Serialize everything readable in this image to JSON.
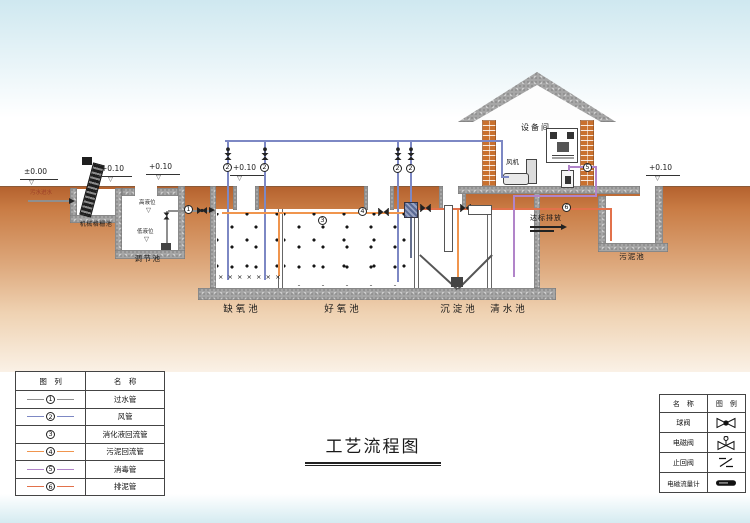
{
  "title": "工艺流程图",
  "colors": {
    "pipe_water": "#8f8f8f",
    "pipe_air": "#7d88c4",
    "pipe_sludge_return": "#f0954e",
    "pipe_disinfect": "#b184c9",
    "pipe_sludge_drain": "#e2714b",
    "brick": "#c9712f",
    "concrete": "#a6a6a6",
    "ground_top": "#b5622e",
    "ground_bottom": "#faf1e6",
    "sky": "#cfe8f0"
  },
  "levels": {
    "zero": "±0.00",
    "plus_10": "+0.10"
  },
  "labels": {
    "equipment_room": "设备间",
    "fan": "风机",
    "screen_tank": "机械格栅池",
    "regulating_tank": "调节池",
    "anoxic_tank": "缺氧池",
    "aerobic_tank": "好氧池",
    "sedimentation_tank": "沉淀池",
    "clear_water_tank": "清水池",
    "sludge_tank": "污泥池",
    "inlet": "污水进水",
    "high_level": "高液位",
    "low_level": "低液位",
    "discharge": "达标排放"
  },
  "markers": {
    "water": "1",
    "air": "2",
    "digest": "3",
    "sludge_return": "4",
    "disinfect": "5",
    "sludge_drain": "6"
  },
  "diffusers": "× × × × × × ×",
  "pipe_legend": {
    "col_symbol": "图　列",
    "col_name": "名　称",
    "rows": [
      {
        "num": "1",
        "name": "过水管",
        "color": "#8f8f8f"
      },
      {
        "num": "2",
        "name": "风管",
        "color": "#7d88c4"
      },
      {
        "num": "3",
        "name": "消化液回流管",
        "color": ""
      },
      {
        "num": "4",
        "name": "污泥回流管",
        "color": "#f0954e"
      },
      {
        "num": "5",
        "name": "消毒管",
        "color": "#b184c9"
      },
      {
        "num": "6",
        "name": "排泥管",
        "color": "#e2714b"
      }
    ]
  },
  "valve_legend": {
    "col_name": "名　称",
    "col_symbol": "图　例",
    "rows": [
      {
        "name": "球阀"
      },
      {
        "name": "电磁阀"
      },
      {
        "name": "止回阀"
      },
      {
        "name": "电磁流量计"
      }
    ]
  }
}
